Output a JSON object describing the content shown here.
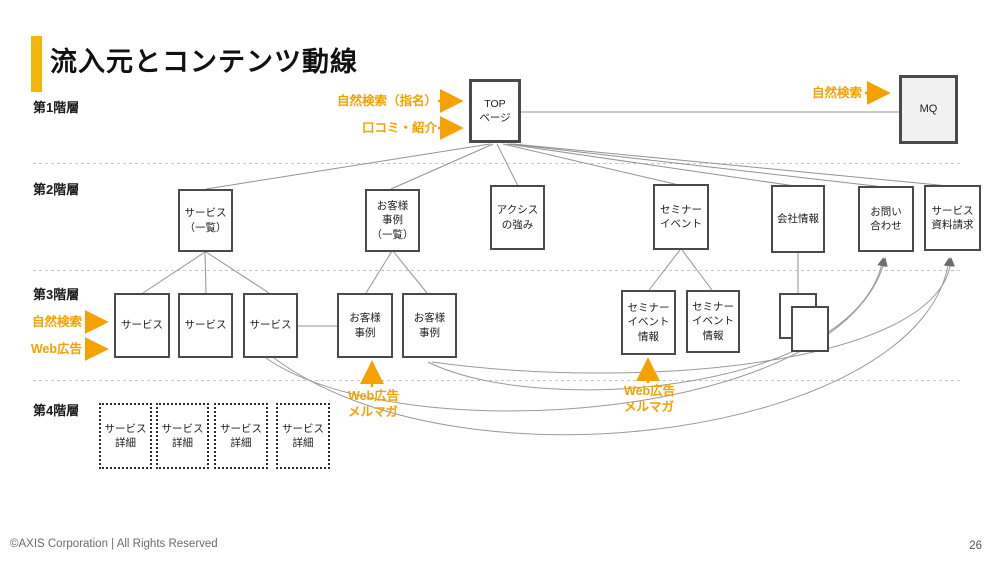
{
  "slide": {
    "title": "流入元とコンテンツ動線",
    "footer": "©AXIS Corporation | All Rights Reserved",
    "page_number": "26"
  },
  "levels": [
    {
      "label": "第1階層"
    },
    {
      "label": "第2階層"
    },
    {
      "label": "第3階層"
    },
    {
      "label": "第4階層"
    }
  ],
  "nodes": {
    "toppage": {
      "label": "TOP\nページ"
    },
    "mq": {
      "label": "MQ"
    },
    "service_list": {
      "label": "サービス\n（一覧）"
    },
    "case_list": {
      "label": "お客様\n事例\n（一覧）"
    },
    "strength": {
      "label": "アクシス\nの強み"
    },
    "seminar": {
      "label": "セミナー\nイベント"
    },
    "company": {
      "label": "会社情報"
    },
    "contact": {
      "label": "お問い\n合わせ"
    },
    "request": {
      "label": "サービス\n資料請求"
    },
    "service1": {
      "label": "サービス"
    },
    "service2": {
      "label": "サービス"
    },
    "service3": {
      "label": "サービス"
    },
    "case1": {
      "label": "お客様\n事例"
    },
    "case2": {
      "label": "お客様\n事例"
    },
    "seminar_info1": {
      "label": "セミナー\nイベント\n情報"
    },
    "seminar_info2": {
      "label": "セミナー\nイベント\n情報"
    },
    "detail1": {
      "label": "サービス\n詳細"
    },
    "detail2": {
      "label": "サービス\n詳細"
    },
    "detail3": {
      "label": "サービス\n詳細"
    },
    "detail4": {
      "label": "サービス\n詳細"
    }
  },
  "inflows": {
    "natural_search_named": "自然検索（指名）",
    "word_of_mouth": "口コミ・紹介",
    "natural_search_mq": "自然検索",
    "natural_search_service": "自然検索",
    "web_ad_service": "Web広告",
    "web_ad_mailmag_case": "Web広告\nメルマガ",
    "web_ad_mailmag_seminar": "Web広告\nメルマガ"
  },
  "colors": {
    "accent_orange": "#F5A100",
    "accent_bar": "#F5B40A",
    "box_border": "#4A4A4A",
    "connector_gray": "#939393",
    "separator_gray": "#C6C6C6"
  }
}
